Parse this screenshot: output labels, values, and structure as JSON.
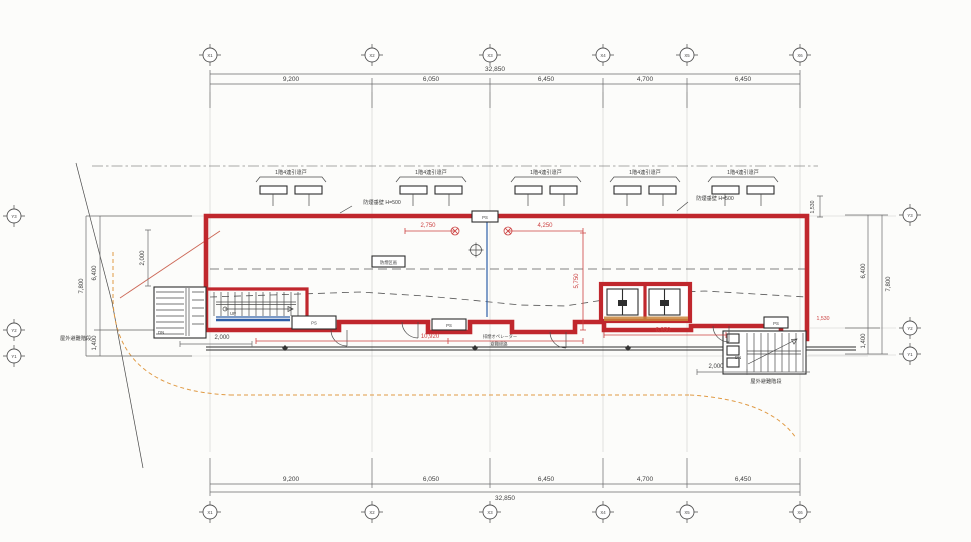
{
  "drawing_type": "architectural-floor-plan",
  "colors": {
    "wall_red": "#c0272d",
    "dim_red": "#cc4040",
    "glazing_blue": "#2f5fa8",
    "boundary_orange": "#e09a44",
    "ink": "#3a3a3a",
    "paper": "#fcfcfa"
  },
  "grid": {
    "x": [
      "X1",
      "X2",
      "X3",
      "X4",
      "X5",
      "X6"
    ],
    "y": [
      "Y3",
      "Y2",
      "Y1"
    ]
  },
  "dimensions": {
    "top": {
      "segments": [
        "9,200",
        "6,050",
        "6,450",
        "4,700",
        "6,450"
      ],
      "total": "32,850"
    },
    "bottom": {
      "segments": [
        "9,200",
        "6,050",
        "6,450",
        "4,700",
        "6,450"
      ],
      "total": "32,850"
    },
    "left": {
      "segments": [
        "6,400",
        "1,400"
      ],
      "total": "7,800"
    },
    "right": {
      "segments": [
        "6,400",
        "1,400"
      ],
      "total": "7,800"
    }
  },
  "red_dims": {
    "r1": "2,750",
    "r2": "4,250",
    "r3": "5,750",
    "r4": "10,920",
    "r5": "6,950",
    "r6": "1,530"
  },
  "black_dims": {
    "b1": "2,000",
    "b2": "2,000",
    "b3": "2,000",
    "b4": "1,530"
  },
  "labels": {
    "window_assembly": "1階4連引違戸",
    "smoke_wall_note": "防煙垂壁 H=500",
    "smoke_zone": "防煙区画",
    "ps": "PS",
    "dn": "DN",
    "up": "UP",
    "escape_stair": "屋外避難階段",
    "escape_route": "避難経路",
    "smoke_operator": "排煙オペレーター"
  }
}
